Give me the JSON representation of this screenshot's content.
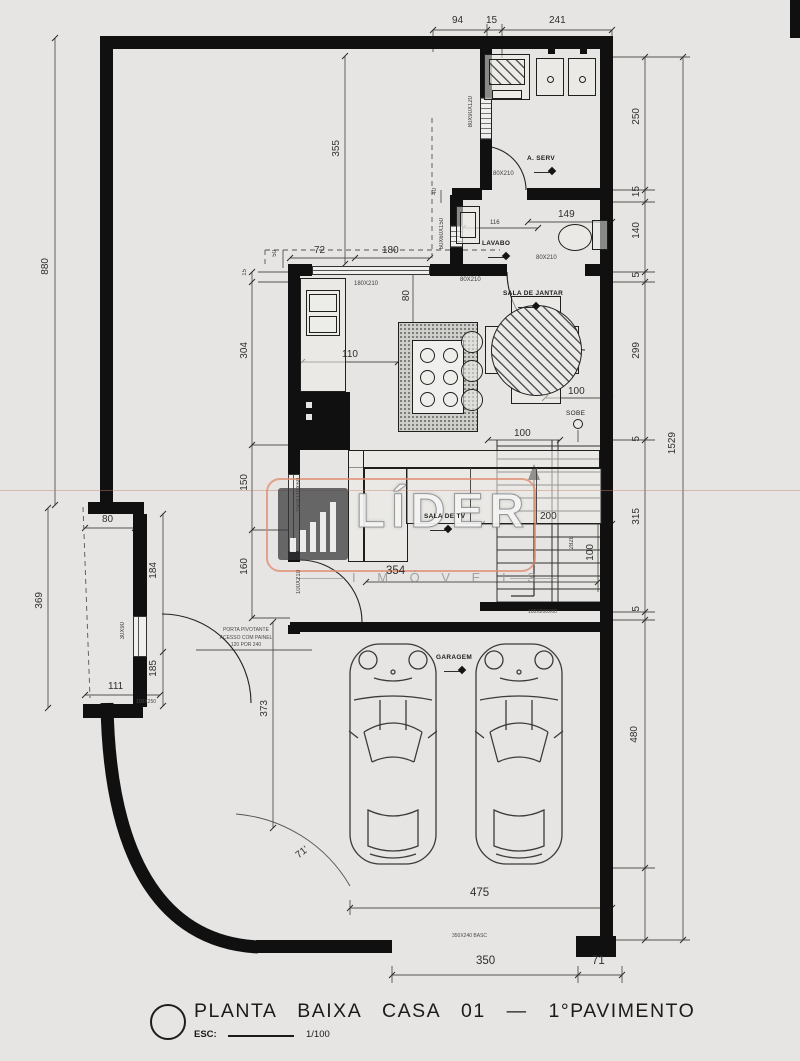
{
  "meta": {
    "bg": "#e6e5e3",
    "wall": "#101010",
    "accent": "#e08a6c"
  },
  "watermark": {
    "brand": "LÍDER",
    "sub": "I M Ó V E I S"
  },
  "title_block": {
    "title": "PLANTA BAIXA CASA 01 — 1°PAVIMENTO",
    "esc_label": "ESC:",
    "esc_value": "1/100"
  },
  "rooms": {
    "laundry": "A. SERV",
    "lavabo": "LAVABO",
    "dining": "SALA DE JANTAR",
    "tv": "SALA DE TV",
    "garage": "GARAGEM",
    "stairs_up": "SOBE"
  },
  "dims": {
    "t94": "94",
    "t15": "15",
    "t241": "241",
    "r250": "250",
    "r15": "15",
    "r140": "140",
    "r5a": "5",
    "r299": "299",
    "r5b": "5",
    "r315": "315",
    "r5c": "5",
    "r480": "480",
    "r1529": "1529",
    "l880": "880",
    "l355": "355",
    "l369": "369",
    "l373": "373",
    "arc71": "71'",
    "k50": "50",
    "k72": "72",
    "k180": "180",
    "k15": "15",
    "k304": "304",
    "k150": "150",
    "k160": "160",
    "k110": "110",
    "k80": "80",
    "k40": "40",
    "v116": "116",
    "v149": "149",
    "d100a": "100",
    "d100b": "100",
    "s200": "200",
    "s100": "100",
    "s2828": "2828",
    "p80": "80",
    "p184": "184",
    "p185": "185",
    "p111": "111",
    "sala354": "354",
    "g475": "475",
    "g350": "350",
    "g71": "71"
  },
  "openings": {
    "d80210a": "80X210",
    "d80210b": "80X210",
    "d80210c": "80X210",
    "w180210": "180X210",
    "w150110": "150X110X60",
    "d100210": "100X210",
    "w6060": "60X60X150",
    "w8090": "80X90X120",
    "w3090": "30X90",
    "d100250": "100X250",
    "s100200": "100X200X00",
    "gate": "350X240 BASC"
  },
  "notes": {
    "line1": "PORTA PIVOTANTE",
    "line2": "ACESSO COM PAINEL",
    "line3": "120 POR 240"
  }
}
